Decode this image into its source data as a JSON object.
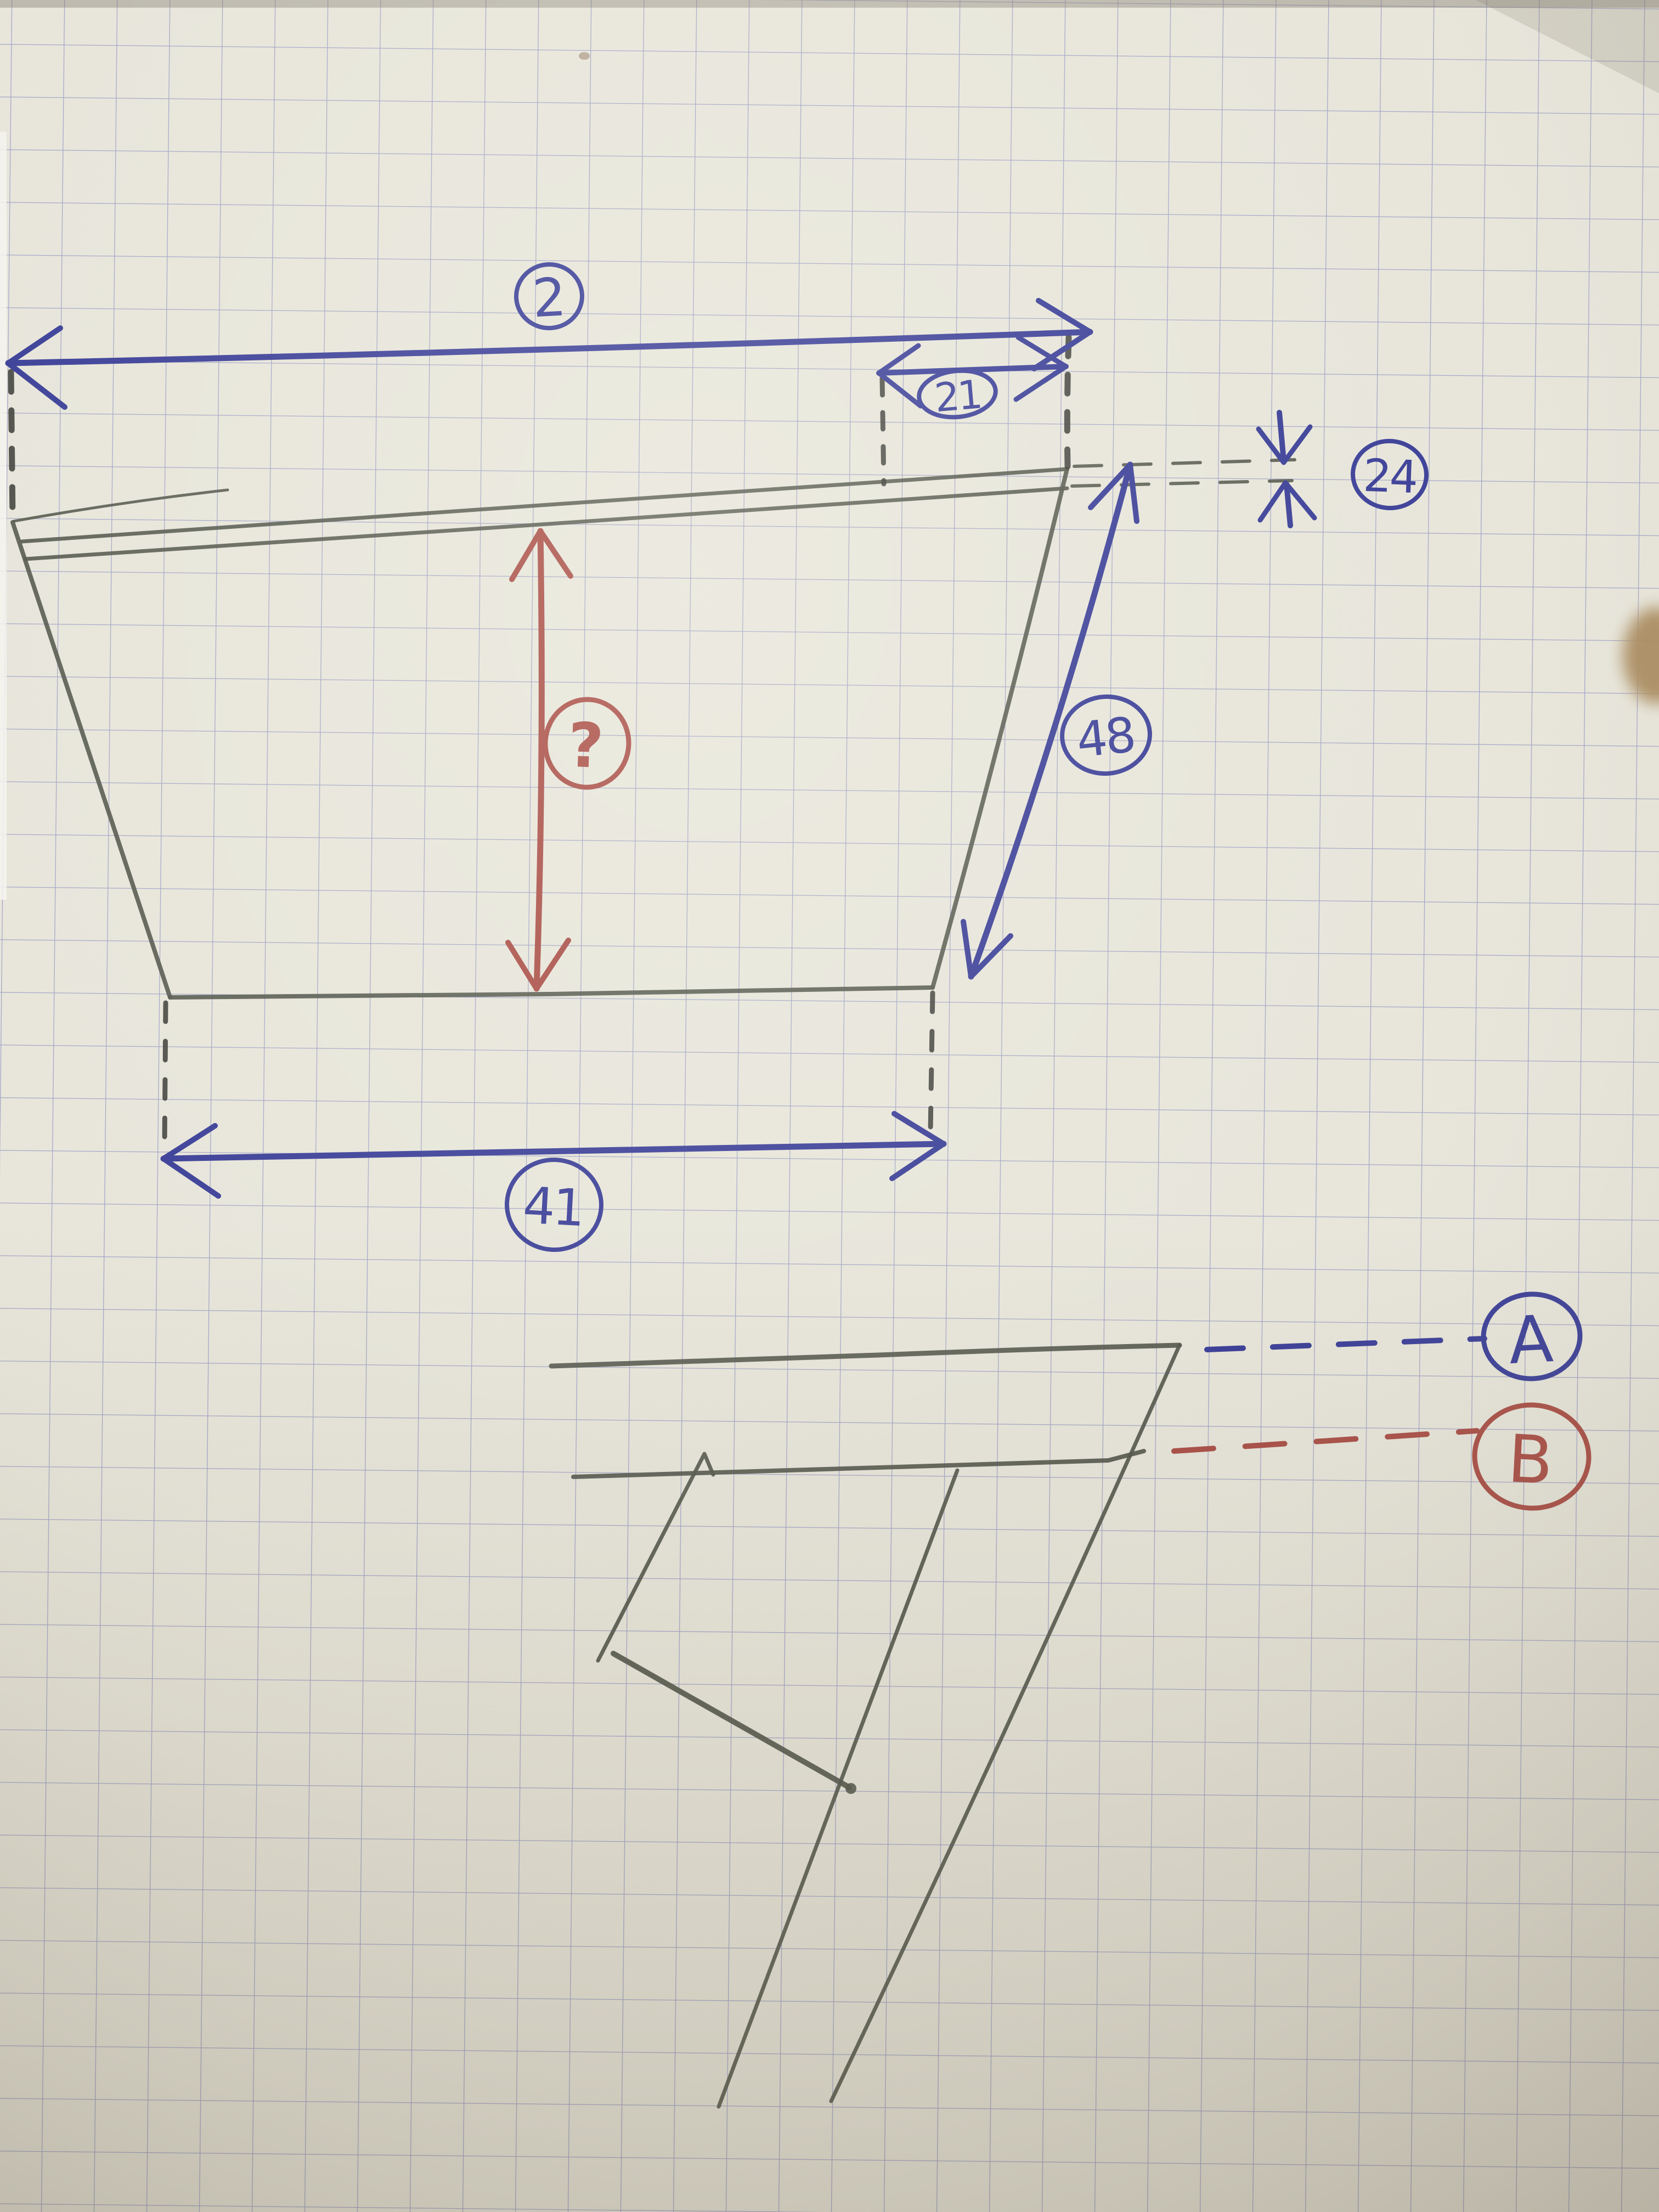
{
  "labels": {
    "top_width": "2",
    "top_right_segment": "21",
    "edge_thickness": "24",
    "slanted_side": "48",
    "bottom_width": "41",
    "unknown_height": "?",
    "reference_a": "A",
    "reference_b": "B"
  },
  "colors": {
    "paper": "#e7e5da",
    "grid_line": "#8a8fbe",
    "pencil": "#53564b",
    "pencil_dark": "#33342f",
    "blue_ink": "#383c96",
    "red_ink": "#a84c44",
    "table_edge": "#a8895c"
  }
}
